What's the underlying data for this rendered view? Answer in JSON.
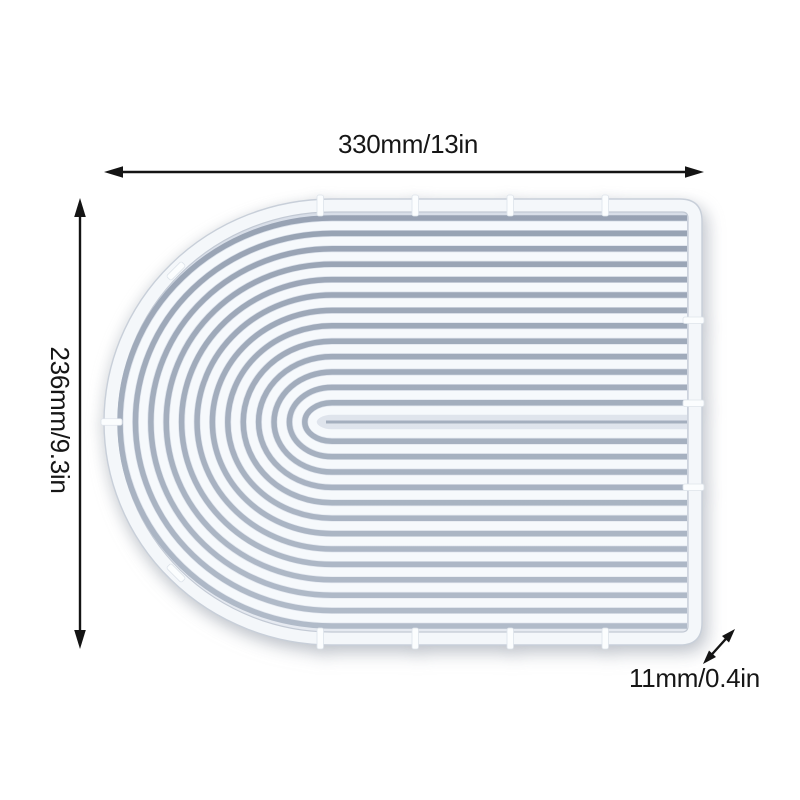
{
  "annotations": {
    "width": {
      "label": "330mm/13in"
    },
    "height": {
      "label": "236mm/9.3in"
    },
    "thickness": {
      "label": "11mm/0.4in"
    }
  },
  "colors": {
    "background": "#ffffff",
    "annotation_ink": "#161616",
    "mold_rim": "#f4f7fa",
    "mold_base_top": "#d8dee8",
    "mold_base_bottom": "#e6eaf1",
    "groove_dark": "#97a2b3",
    "groove_light": "#b2bcca",
    "ridge": "#f6f9fc",
    "edge_line": "#c8cfd9",
    "tab": "#fbfdfe"
  }
}
